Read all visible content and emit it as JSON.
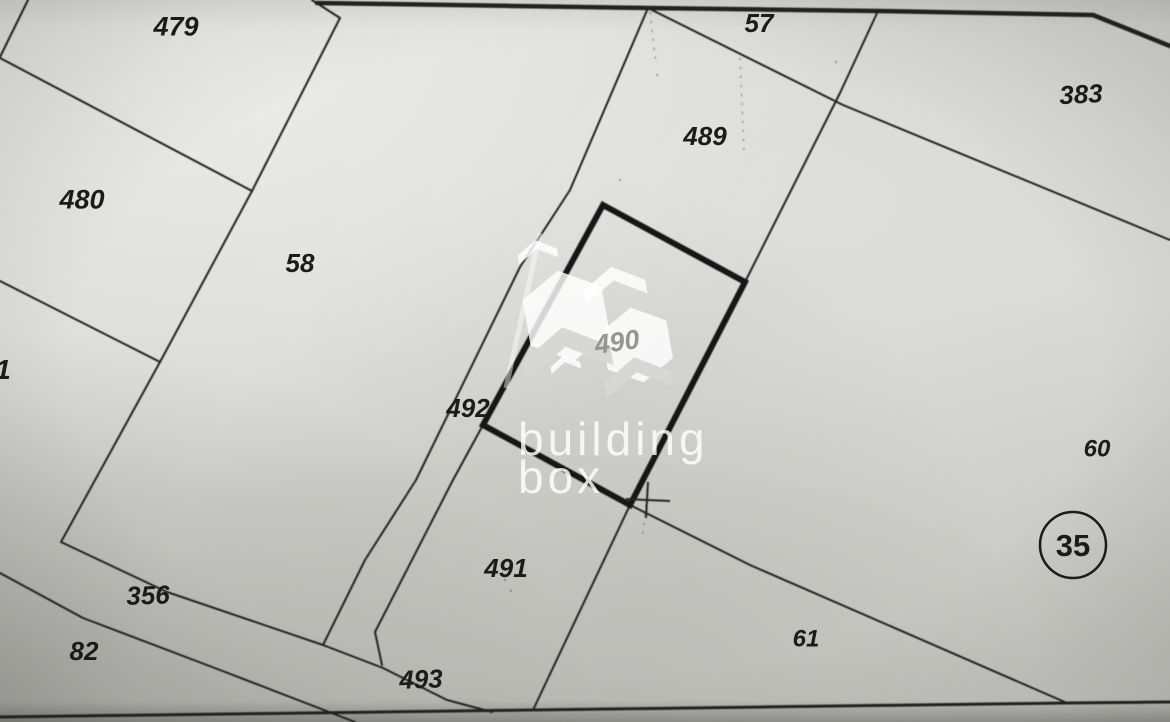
{
  "map": {
    "type": "scanned cadastral plat map",
    "parcel_labels": [
      {
        "id": "479",
        "x": 176,
        "y": 26,
        "fs": 27,
        "rot": 0
      },
      {
        "id": "480",
        "x": 82,
        "y": 199,
        "fs": 27,
        "rot": 0
      },
      {
        "id": "58",
        "x": 300,
        "y": 263,
        "fs": 26,
        "rot": 0
      },
      {
        "id": "57",
        "x": 759,
        "y": 23,
        "fs": 26,
        "rot": 0
      },
      {
        "id": "489",
        "x": 705,
        "y": 136,
        "fs": 26,
        "rot": 0
      },
      {
        "id": "383",
        "x": 1081,
        "y": 94,
        "fs": 26,
        "rot": -3
      },
      {
        "id": "492",
        "x": 468,
        "y": 408,
        "fs": 26,
        "rot": 0
      },
      {
        "id": "60",
        "x": 1097,
        "y": 448,
        "fs": 24,
        "rot": 0
      },
      {
        "id": "491",
        "x": 506,
        "y": 568,
        "fs": 26,
        "rot": 0
      },
      {
        "id": "61",
        "x": 806,
        "y": 638,
        "fs": 24,
        "rot": 0
      },
      {
        "id": "356",
        "x": 148,
        "y": 595,
        "fs": 26,
        "rot": -2
      },
      {
        "id": "82",
        "x": 84,
        "y": 651,
        "fs": 26,
        "rot": 0
      },
      {
        "id": "493",
        "x": 421,
        "y": 679,
        "fs": 26,
        "rot": -2
      },
      {
        "id": "1",
        "x": 3,
        "y": 369,
        "fs": 28,
        "rot": 0
      }
    ],
    "circled_parcel": {
      "id": "35",
      "cx": 1073,
      "cy": 545,
      "r": 33,
      "fs": 31
    },
    "boundary_lines": [
      {
        "name": "top-boundary-bold",
        "w": 4.5,
        "pts": "317,3 648,8 878,11 1093,15 1170,46"
      },
      {
        "name": "northwest-corner-cut",
        "w": 2,
        "pts": "28,0 0,57"
      },
      {
        "name": "boundary-479-480",
        "w": 2,
        "pts": "0,58 252,191"
      },
      {
        "name": "west-long-boundary",
        "w": 2,
        "pts": "312,0 340,18 252,191 160,362 61,542"
      },
      {
        "name": "boundary-480-sliver",
        "w": 2,
        "pts": "0,281 160,362"
      },
      {
        "name": "central-boundary",
        "w": 2,
        "pts": "648,8 570,190 520,267 416,480 365,560 323,645"
      },
      {
        "name": "northeast-diagonal",
        "w": 2,
        "pts": "648,8 843,105 1170,240"
      },
      {
        "name": "boundary-489-383",
        "w": 2,
        "pts": "878,11 840,93 745,282"
      },
      {
        "name": "boundary-60-61",
        "w": 2,
        "pts": "630,505 750,565 1067,703"
      },
      {
        "name": "boundary-491-61",
        "w": 2,
        "pts": "630,505 533,710"
      },
      {
        "name": "boundary-492-491",
        "w": 2,
        "pts": "483,425 453,480 375,632 382,665"
      },
      {
        "name": "road-north-edge",
        "w": 2,
        "pts": "61,542 167,592 323,645 383,668 447,700 492,712"
      },
      {
        "name": "road-south-edge",
        "w": 2,
        "pts": "0,573 83,618 220,670 355,722"
      },
      {
        "name": "south-boundary",
        "w": 3,
        "pts": "0,717 533,710 1067,703 1170,702"
      }
    ],
    "highlight_parcel": {
      "id": "490",
      "pts": "603,205 745,282 630,505 483,425",
      "w": 6
    },
    "survey_cross": {
      "h": "626,499 670,501",
      "v": "648,482 646,518",
      "w": 2
    },
    "dotted_artifacts": [
      {
        "name": "dots-near-top-junction",
        "pts": "650,12 656,64"
      },
      {
        "name": "dots-parcel-489",
        "pts": "740,58 744,152"
      },
      {
        "name": "dots-below-cross",
        "pts": "646,505 642,540"
      }
    ],
    "specks": [
      [
        505,
        580
      ],
      [
        511,
        591
      ],
      [
        657,
        75
      ],
      [
        620,
        180
      ],
      [
        836,
        62
      ]
    ]
  },
  "watermark": {
    "line1": "building",
    "line2": "box",
    "ref": "490"
  },
  "colors": {
    "paper": "#d7d7d3",
    "line": "#232321",
    "bold_line": "#151513",
    "label": "#1b1b1a",
    "watermark_white": "#ffffff",
    "watermark_gray": "#8f8f8b"
  }
}
